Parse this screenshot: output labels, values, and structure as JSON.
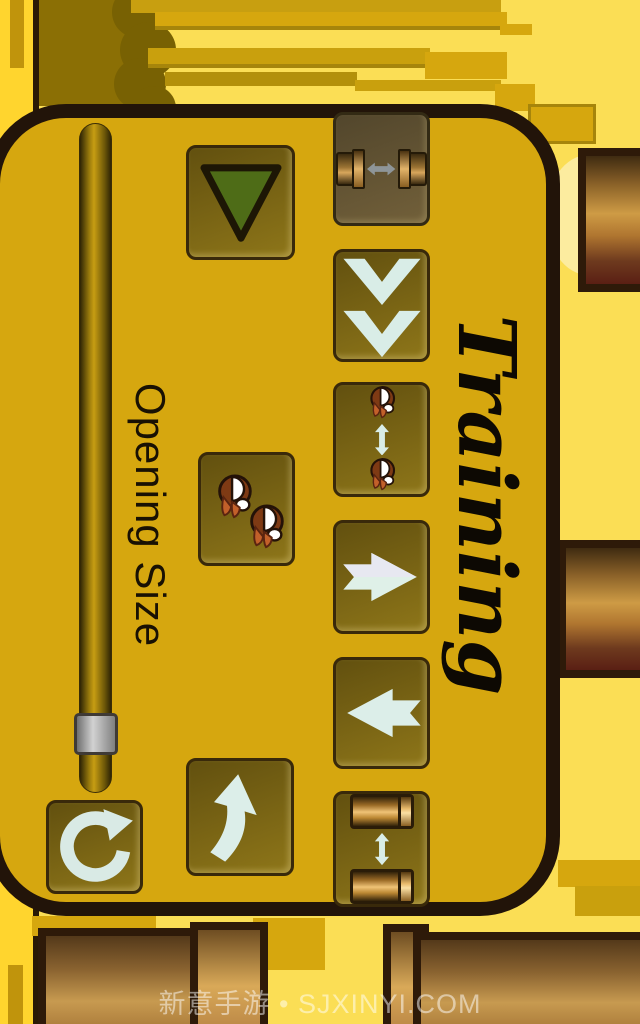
{
  "screen": {
    "width": 640,
    "height": 1024,
    "orientation": "landscape-game-rotated-90"
  },
  "title": {
    "text": "Training",
    "style": "black script, rotated 90deg"
  },
  "watermark": {
    "text": "新意手游 • SJXINYI.COM"
  },
  "slider": {
    "label": "Opening Size",
    "orientation": "vertical",
    "handle_position": "near bottom of track"
  },
  "buttons": [
    {
      "name": "speed-down",
      "icon": "green-down-triangle"
    },
    {
      "name": "pipe-horizontal-gap",
      "icon": "two-pipes-horizontal-double-arrow",
      "state": "pressed-dark"
    },
    {
      "name": "scroll-down",
      "icon": "double-chevron-down"
    },
    {
      "name": "bird-vertical-gap",
      "icon": "bird-arrow-bird-vertical"
    },
    {
      "name": "two-birds",
      "icon": "two-birds-diagonal"
    },
    {
      "name": "move-right",
      "icon": "notched-arrow-right"
    },
    {
      "name": "move-left",
      "icon": "notched-arrow-left"
    },
    {
      "name": "pipe-vertical-gap",
      "icon": "two-shells-vertical-double-arrow"
    },
    {
      "name": "reset",
      "icon": "circular-arrow"
    },
    {
      "name": "flap-up",
      "icon": "curved-up-arrow"
    }
  ],
  "colors": {
    "panel_fill": "#D6A70F",
    "panel_border": "#221409",
    "background_light": "#FBDE55",
    "background_strip": "#FFD52E",
    "button_fill_dark": "#62500F",
    "button_fill_light": "#8E7619",
    "icon_pale": "#DCEEE9",
    "triangle_green": "#4E6C17",
    "bird_brown": "#7E3A14",
    "beak_orange": "#C2602A",
    "arrow_gray": "#8E9598"
  }
}
